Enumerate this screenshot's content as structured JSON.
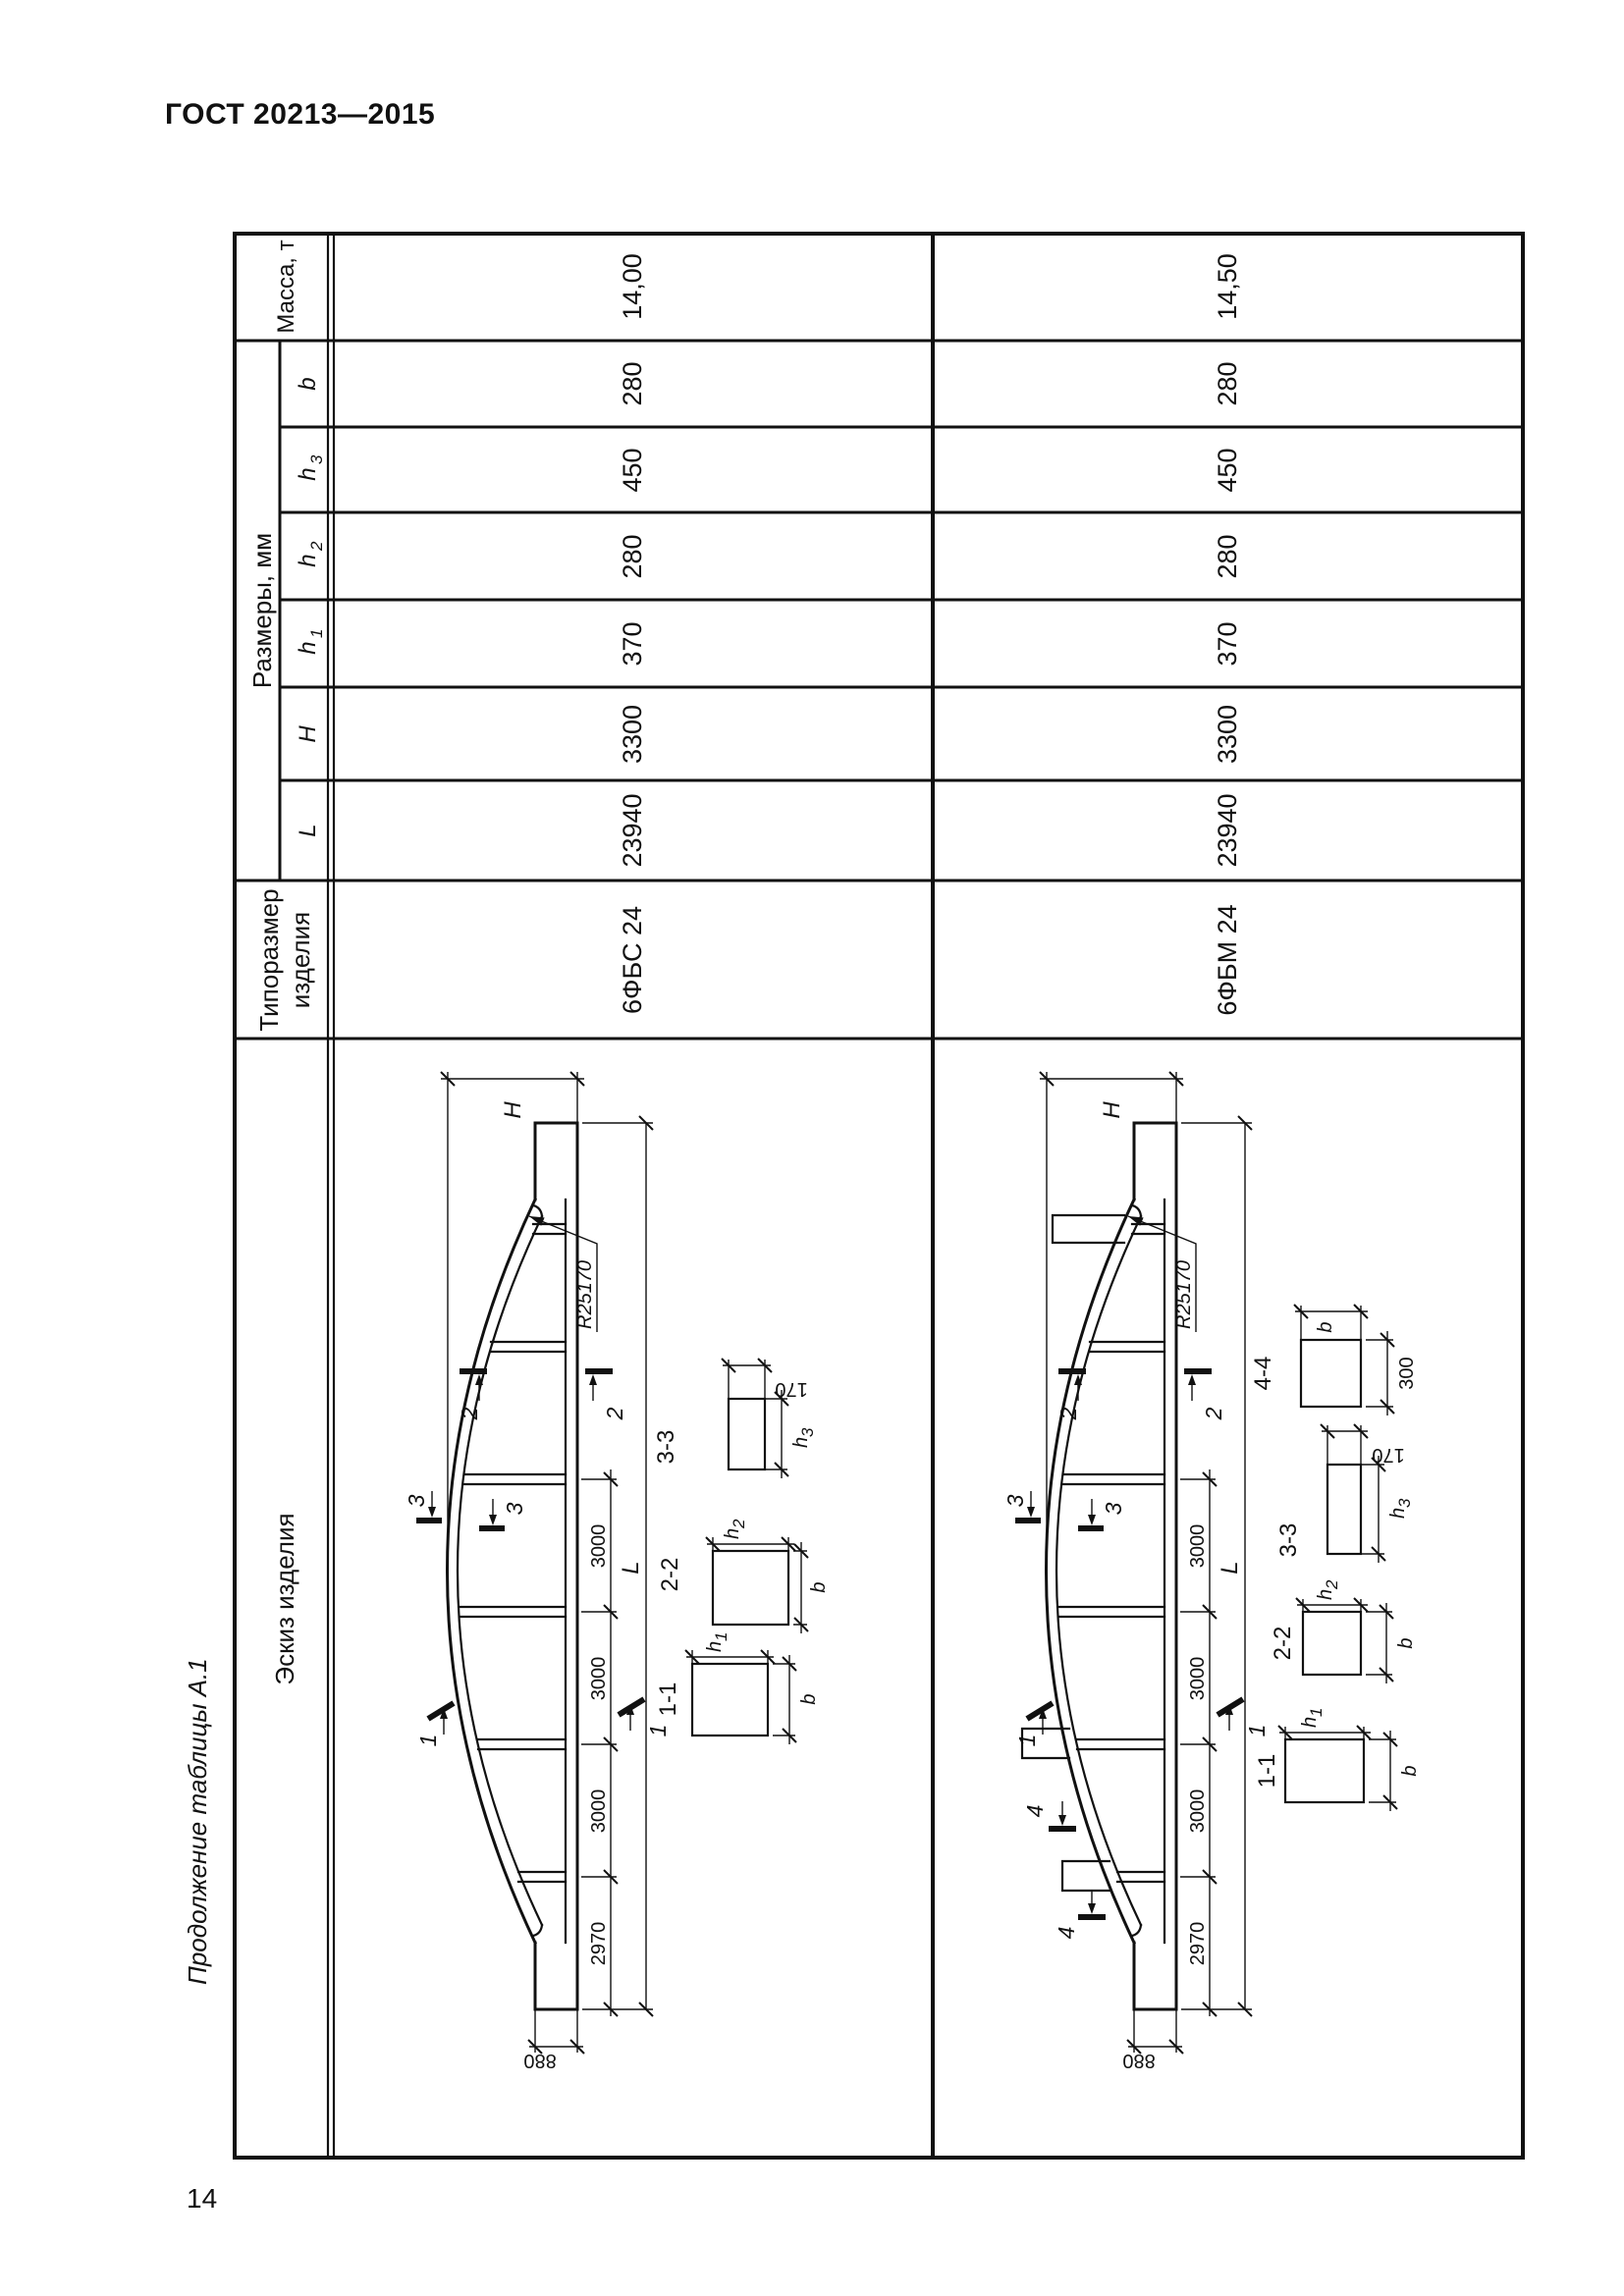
{
  "page": {
    "standard": "ГОСТ 20213—2015",
    "table_caption": "Продолжение таблицы А.1",
    "page_number": "14"
  },
  "table": {
    "headers": {
      "sketch": "Эскиз изделия",
      "type_size_line1": "Типоразмер",
      "type_size_line2": "изделия",
      "dimensions_group": "Размеры, мм",
      "col_L": "L",
      "col_H": "H",
      "col_h_base": "h",
      "col_h1_sub": "1",
      "col_h2_sub": "2",
      "col_h3_sub": "3",
      "col_b": "b",
      "mass": "Масса, т"
    },
    "rows": [
      {
        "type_size": "6ФБС 24",
        "L": "23940",
        "H": "3300",
        "h1": "370",
        "h2": "280",
        "h3": "450",
        "b": "280",
        "mass": "14,00"
      },
      {
        "type_size": "6ФБМ 24",
        "L": "23940",
        "H": "3300",
        "h1": "370",
        "h2": "280",
        "h3": "450",
        "b": "280",
        "mass": "14,50"
      }
    ]
  },
  "sketch": {
    "dim_H": "H",
    "dim_L": "L",
    "radius": "R25170",
    "dim_880": "880",
    "chain": [
      "2970",
      "3000",
      "3000",
      "3000"
    ],
    "cut_labels": {
      "c1": "1",
      "c2": "2",
      "c3": "3",
      "c4": "4"
    },
    "sections": {
      "s11": "1-1",
      "s22": "2-2",
      "s33": "3-3",
      "s44": "4-4",
      "dim_b": "b",
      "dim_h_base": "h",
      "sub1": "1",
      "sub2": "2",
      "sub3": "3",
      "dim_170": "170",
      "dim_300": "300"
    }
  }
}
